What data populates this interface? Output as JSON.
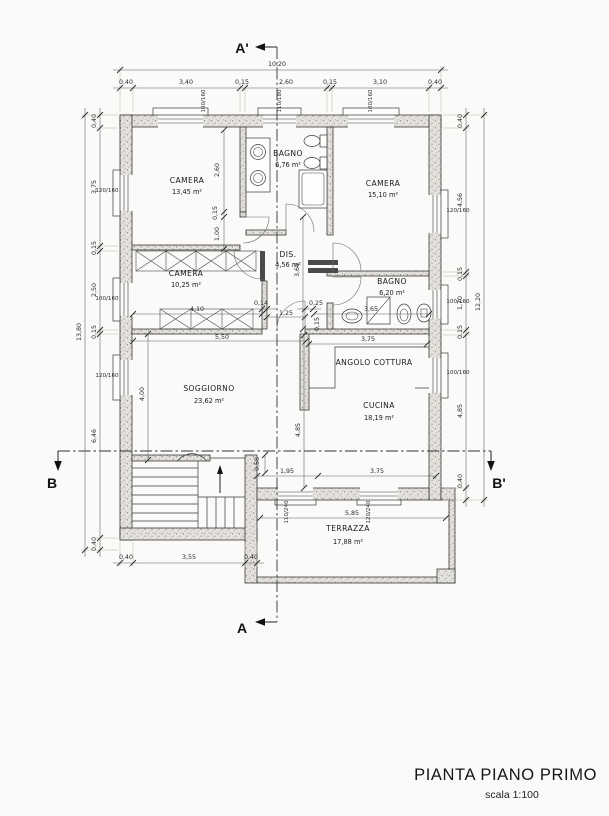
{
  "drawing": {
    "title": "PIANTA PIANO PRIMO",
    "scale_note": "scala 1:100"
  },
  "sections": {
    "a_top": "A'",
    "a_bottom": "A",
    "b_left": "B",
    "b_right": "B'"
  },
  "rooms": {
    "camera_nw": {
      "name": "CAMERA",
      "area": "13,45 m²"
    },
    "bagno_top": {
      "name": "BAGNO",
      "area": "6,76 m²"
    },
    "camera_ne": {
      "name": "CAMERA",
      "area": "15,10 m²"
    },
    "camera_w": {
      "name": "CAMERA",
      "area": "10,25 m²"
    },
    "disimpegno": {
      "name": "DIS.",
      "area": "4,56 m²"
    },
    "bagno_mid": {
      "name": "BAGNO",
      "area": "6,20 m²"
    },
    "soggiorno": {
      "name": "SOGGIORNO",
      "area": "23,62 m²"
    },
    "angolo_cottura": {
      "name": "ANGOLO COTTURA"
    },
    "cucina": {
      "name": "CUCINA",
      "area": "18,19 m²"
    },
    "terrazza": {
      "name": "TERRAZZA",
      "area": "17,88 m²"
    }
  },
  "dims": {
    "top_total": "10,20",
    "top": [
      "0,40",
      "3,40",
      "0,15",
      "2,60",
      "0,15",
      "3,10",
      "0,40"
    ],
    "left_total": "13,80",
    "left": [
      "0,40",
      "3,75",
      "0,15",
      "2,50",
      "0,15",
      "6,46",
      "0,40"
    ],
    "right_total": "12,20",
    "right": [
      "0,40",
      "4,56",
      "0,15",
      "1,70",
      "0,15",
      "4,85",
      "0,40"
    ],
    "bottom": [
      "0,40",
      "3,55",
      "0,40"
    ],
    "interior": {
      "camera_nw_depth": "2,60",
      "camera_nw_wall": "0,15",
      "camera_nw_door": "1,00",
      "camera_w_width": "4,10",
      "soggiorno_width": "5,50",
      "dis_wall": "0,14",
      "dis_door": "1,25",
      "dis_stub": "0,25",
      "dis_wall2": "0,15",
      "dis_depth": "3,65",
      "bagno_mid_width": "3,65",
      "cucina_width": "3,75",
      "soggiorno_depth": "4,00",
      "cucina_depth": "4,85",
      "stair_landing": "0,58",
      "terrace_door_span": "1,95",
      "terrace_span": "3,75",
      "terrazza_width": "5,85"
    }
  },
  "window_sizes": {
    "top_left": "100/160",
    "top_center": "110/180",
    "top_right": "100/160",
    "left_upper": "120/160",
    "left_middle": "100/160",
    "left_lower": "120/160",
    "right_upper": "120/160",
    "right_middle": "100/160",
    "right_lower": "100/160",
    "terrace_door_left": "110/240",
    "terrace_door_right": "120/240"
  }
}
